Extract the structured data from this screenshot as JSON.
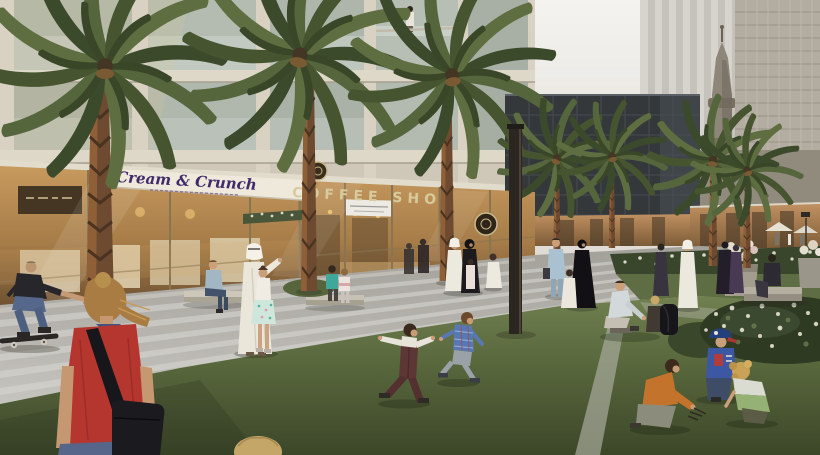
{
  "image": {
    "kind": "architectural-rendering",
    "description": "Dusk view of a landscaped park promenade lined with palm trees and glowing retail storefronts at the base of cream residential buildings; towers and a minaret rise behind; families in western and Emirati dress stroll while children play on the lawn"
  },
  "signs": {
    "dessert_shop_label": "Cream & Crunch",
    "coffee_shop_label": "COFFEE SHOP"
  },
  "palette": {
    "sky": "#f0efec",
    "facade_cream": "#d3ccbd",
    "storefront_glow": "#c79a5e",
    "dark_glass_building": "#34383b",
    "paving": "#b7b5ae",
    "grass_light": "#70804f",
    "grass_dark": "#3e4929",
    "palm_frond": "#4d5a35",
    "palm_trunk": "#6d4a30",
    "sign_purple": "#3f2a6a",
    "coffee_letters": "#d7cb9e",
    "red_shirt": "#b5362f",
    "lamp_post": "#2b2620"
  },
  "figures": [
    "skateboarder",
    "woman-in-red-with-bag",
    "man-seated-on-bench",
    "emirati-man-walking-with-girl",
    "two-children-on-curb",
    "running-boy-maroon-vest",
    "running-boy-plaid-shirt",
    "family-in-traditional-dress",
    "man-in-blue-suit",
    "woman-in-abaya-with-boy",
    "toddler-in-kandura",
    "father-seated-on-lawn-with-child",
    "kneeling-boy-orange-shirt",
    "boy-with-blue-cap",
    "crouching-child-green-shirt",
    "pedestrians-near-right-shops",
    "person-on-stone-bench",
    "person-on-balcony",
    "child-head-bottom-edge"
  ]
}
